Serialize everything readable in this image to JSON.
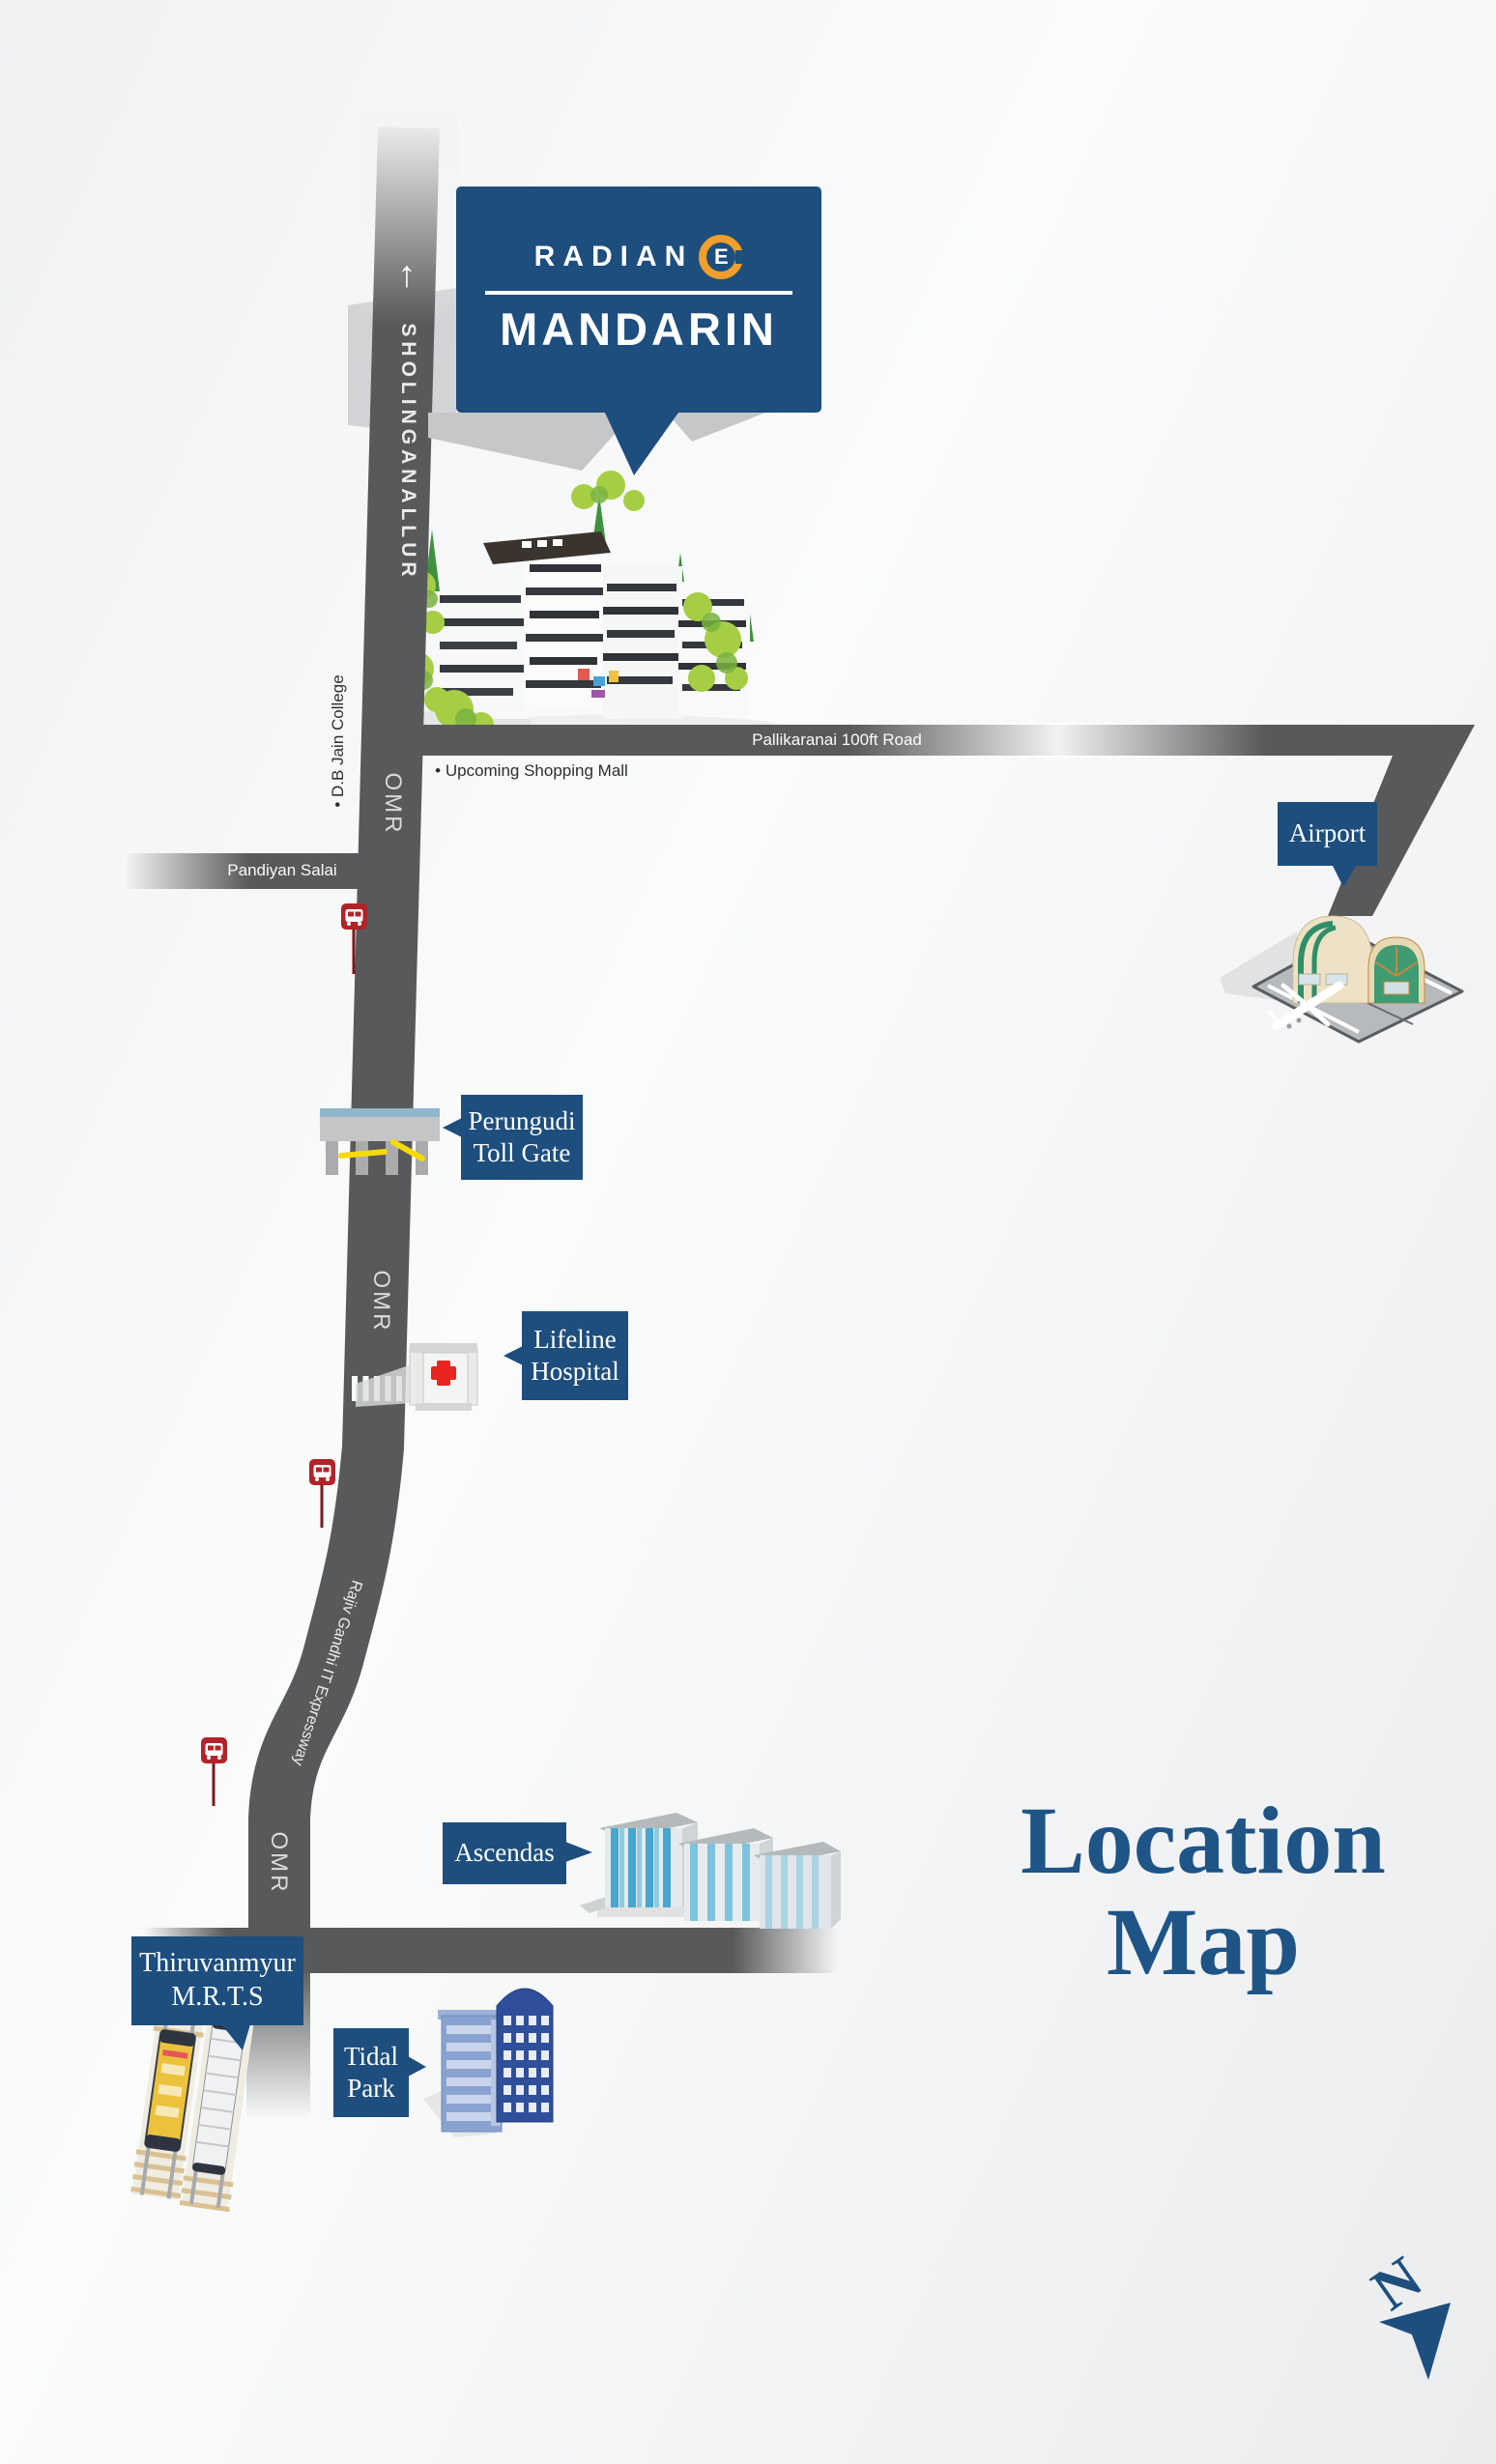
{
  "callout": {
    "brand_prefix": "RADIAN",
    "brand_mark_letter": "E",
    "project": "MANDARIN"
  },
  "roads": {
    "sholinganallur": "SHOLINGANALLUR",
    "up_arrow": "↑",
    "omr": "OMR",
    "pallikaranai": "Pallikaranai 100ft Road",
    "pandiyan_salai": "Pandiyan Salai",
    "rajiv_gandhi": "Rajiv Gandhi IT Expressway"
  },
  "poi_notes": {
    "db_jain_college": "• D.B Jain College",
    "upcoming_mall": "• Upcoming Shopping Mall"
  },
  "landmarks": {
    "airport": {
      "label": "Airport"
    },
    "toll": {
      "line1": "Perungudi",
      "line2": "Toll Gate"
    },
    "hospital": {
      "line1": "Lifeline",
      "line2": "Hospital"
    },
    "ascendas": {
      "label": "Ascendas"
    },
    "mrts": {
      "line1": "Thiruvanmyur",
      "line2": "M.R.T.S"
    },
    "tidal": {
      "line1": "Tidal",
      "line2": "Park"
    }
  },
  "title": {
    "line1": "Location",
    "line2": "Map"
  },
  "compass": {
    "letter": "N"
  },
  "colors": {
    "label_blue": "#1d4e7d",
    "title_blue": "#1e5486",
    "road_gray": "#58595b",
    "bus_red": "#b2232a",
    "logo_orange": "#f09f2c",
    "barrier_yellow": "#f7d908",
    "hospital_red": "#e8251f"
  }
}
